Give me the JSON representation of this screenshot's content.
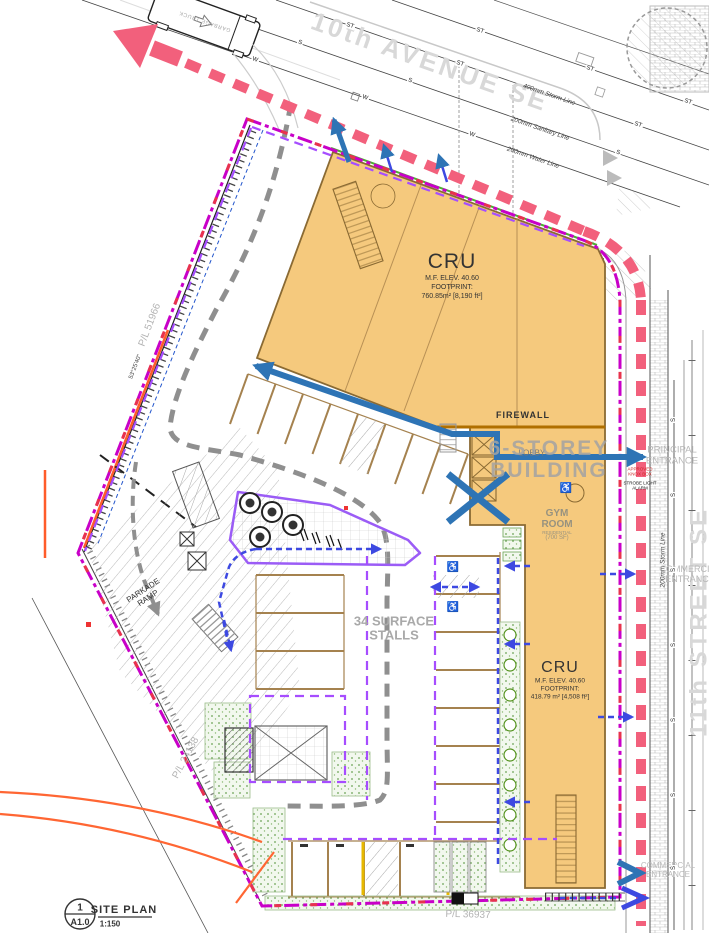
{
  "streets": {
    "avenue": "10th AVENUE SE",
    "street": "11th STREET SE"
  },
  "utilities": {
    "storm": "400mm Storm Line",
    "sanitary": "200mm Sanitary Line",
    "water": "200mm Water Line",
    "storm_east": "200mm Storm Line"
  },
  "buildings": {
    "cru_upper": {
      "name": "CRU",
      "elev": "M.F. ELEV. 40.60",
      "footprint_label": "FOOTPRINT:",
      "area": "760.85m² [8,190 ft²]"
    },
    "cru_lower": {
      "name": "CRU",
      "elev": "M.F. ELEV. 40.60",
      "footprint_label": "FOOTPRINT:",
      "area": "418.79 m² [4,508 ft²]"
    },
    "six_storey": {
      "line1": "6-STOREY",
      "line2": "BUILDING",
      "lobby": "LOBBY",
      "firewall": "FIREWALL"
    },
    "gym": {
      "line1": "GYM",
      "line2": "ROOM",
      "line3": "RESIDENTIAL",
      "line4": "(700 SF)"
    }
  },
  "site": {
    "stalls_line1": "34 SURFACE",
    "stalls_line2": "STALLS",
    "ramp_line1": "PARKADE",
    "ramp_line2": "RAMP",
    "garbage_truck": "GARBAGE TRUCK"
  },
  "entrances": {
    "principal1": "PRINCIPAL",
    "principal2": "ENTRANCE",
    "commercial1": "COMMERCIAL",
    "commercial2": "ENTRANCE",
    "south1": "COMMERCIAL",
    "south2": "ENTRANCE"
  },
  "annotations": {
    "knox1": "APPROVED",
    "knox2": "KNOX BOX",
    "strobe1": "STROBE LIGHT",
    "strobe2": "ALARM"
  },
  "property_lines": {
    "west": "P/L 51966",
    "bearing": "53°25'40\"",
    "southwest": "P/L 24138",
    "south": "P/L 36937"
  },
  "title_block": {
    "number": "1",
    "sheet": "A1.0",
    "title": "SITE PLAN",
    "scale": "1:150"
  },
  "symbols": {
    "accessible": "♿"
  },
  "colors": {
    "building_fill": "#f5c97d",
    "building_edge": "#8a6a33",
    "property_line": "#c800c8",
    "fire_route": "#f2607c",
    "route_blue": "#2e74b5",
    "path_blue": "#3d49e1",
    "aisle_gray": "#8f8f8f",
    "landscape_green": "#4caf32",
    "accent_orange": "#ff5c2a",
    "street_text": "#d8d8d8"
  },
  "utility_markers": [
    {
      "t": "ST",
      "x": 480,
      "y": 31,
      "r": 19
    },
    {
      "t": "ST",
      "x": 590,
      "y": 69,
      "r": 19
    },
    {
      "t": "ST",
      "x": 688,
      "y": 102,
      "r": 19
    },
    {
      "t": "ST",
      "x": 350,
      "y": 26,
      "r": 19
    },
    {
      "t": "ST",
      "x": 460,
      "y": 64,
      "r": 19
    },
    {
      "t": "ST",
      "x": 638,
      "y": 125,
      "r": 19
    },
    {
      "t": "S",
      "x": 300,
      "y": 43,
      "r": 19
    },
    {
      "t": "S",
      "x": 410,
      "y": 81,
      "r": 19
    },
    {
      "t": "S",
      "x": 618,
      "y": 153,
      "r": 19
    },
    {
      "t": "W",
      "x": 255,
      "y": 60,
      "r": 19
    },
    {
      "t": "W",
      "x": 365,
      "y": 98,
      "r": 19
    },
    {
      "t": "W",
      "x": 472,
      "y": 135,
      "r": 19
    },
    {
      "t": "S",
      "x": 674,
      "y": 420,
      "r": -90
    },
    {
      "t": "S",
      "x": 674,
      "y": 495,
      "r": -90
    },
    {
      "t": "S",
      "x": 674,
      "y": 570,
      "r": -90
    },
    {
      "t": "S",
      "x": 674,
      "y": 645,
      "r": -90
    },
    {
      "t": "S",
      "x": 674,
      "y": 720,
      "r": -90
    },
    {
      "t": "S",
      "x": 674,
      "y": 795,
      "r": -90
    },
    {
      "t": "S",
      "x": 674,
      "y": 868,
      "r": -90
    },
    {
      "t": "♿",
      "x": 453,
      "y": 568,
      "r": 0,
      "c": "wc"
    },
    {
      "t": "♿",
      "x": 453,
      "y": 608,
      "r": 0,
      "c": "wc"
    },
    {
      "t": "♿",
      "x": 566,
      "y": 489,
      "r": 0,
      "c": "wc"
    }
  ]
}
